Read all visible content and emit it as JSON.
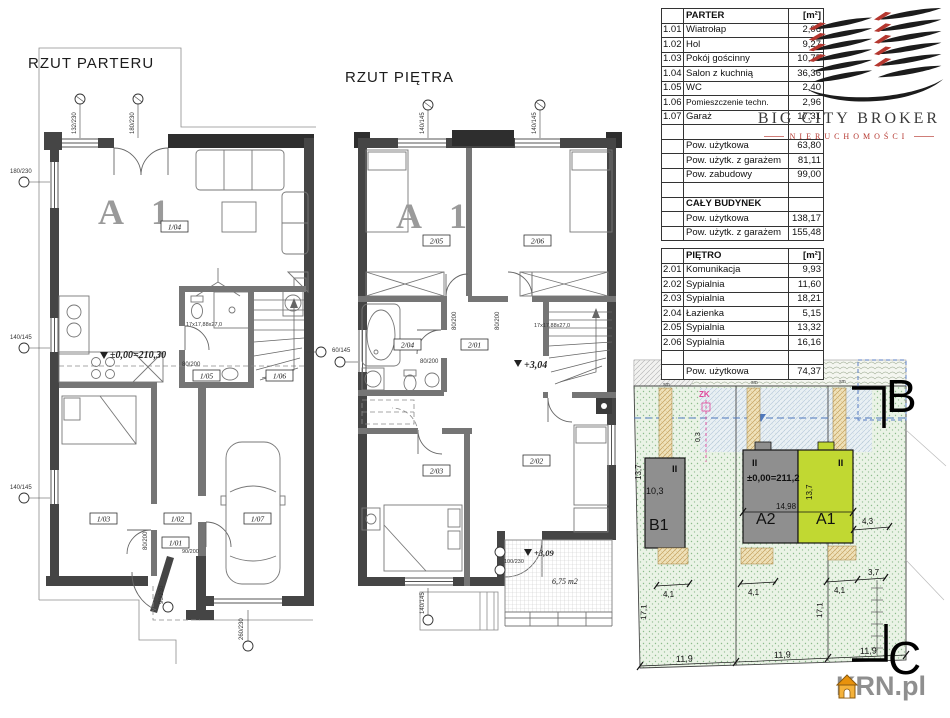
{
  "parter_plan": {
    "title": "RZUT PARTERU",
    "unit_label": "A 1",
    "level_mark": "±0,00=210,30",
    "stair_note": "17x17,88x27,0",
    "rooms": {
      "r101": "1/01",
      "r102": "1/02",
      "r103": "1/03",
      "r104": "1/04",
      "r105": "1/05",
      "r106": "1/06",
      "r107": "1/07"
    },
    "dims": {
      "win_top1": "132/230",
      "door_top": "180/230",
      "win_left1": "180/230",
      "win_left2": "140/145",
      "win_left3": "140/145",
      "door_a": "80/200",
      "door_b": "80/200",
      "door_entry": "90/200",
      "door_side": "90/230",
      "garage_door": "260/230"
    }
  },
  "pietro_plan": {
    "title": "RZUT PIĘTRA",
    "unit_label": "A 1",
    "level_mark": "+3,04",
    "balcony_level": "+3,09",
    "balcony_area": "6,75 m2",
    "stair_note": "17x17,88x27,0",
    "rooms": {
      "r201": "2/01",
      "r202": "2/02",
      "r203": "2/03",
      "r204": "2/04",
      "r205": "2/05",
      "r206": "2/06"
    },
    "dims": {
      "win_top1": "140/145",
      "win_top2": "140/145",
      "win_left": "60/145",
      "win_bottom": "140/145",
      "door_a": "80/200",
      "door_b": "80/200",
      "door_c": "80/200",
      "balcony_door": "100/230"
    }
  },
  "tables": {
    "parter": {
      "title": "PARTER",
      "unit": "[m²]",
      "rows": [
        {
          "no": "1.01",
          "name": "Wiatrołap",
          "area": "2,06"
        },
        {
          "no": "1.02",
          "name": "Hol",
          "area": "9,27"
        },
        {
          "no": "1.03",
          "name": "Pokój gościnny",
          "area": "10,75"
        },
        {
          "no": "1.04",
          "name": "Salon z kuchnią",
          "area": "36,36"
        },
        {
          "no": "1.05",
          "name": "WC",
          "area": "2,40"
        },
        {
          "no": "1.06",
          "name": "Pomieszczenie techn.",
          "area": "2,96"
        },
        {
          "no": "1.07",
          "name": "Garaż",
          "area": "17,31"
        }
      ],
      "summary": [
        {
          "name": "Pow. użytkowa",
          "area": "63,80"
        },
        {
          "name": "Pow. użytk. z garażem",
          "area": "81,11"
        },
        {
          "name": "Pow. zabudowy",
          "area": "99,00"
        }
      ],
      "building_title": "CAŁY BUDYNEK",
      "building": [
        {
          "name": "Pow. użytkowa",
          "area": "138,17"
        },
        {
          "name": "Pow. użytk. z garażem",
          "area": "155,48"
        }
      ]
    },
    "pietro": {
      "title": "PIĘTRO",
      "unit": "[m²]",
      "rows": [
        {
          "no": "2.01",
          "name": "Komunikacja",
          "area": "9,93"
        },
        {
          "no": "2.02",
          "name": "Sypialnia",
          "area": "11,60"
        },
        {
          "no": "2.03",
          "name": "Sypialnia",
          "area": "18,21"
        },
        {
          "no": "2.04",
          "name": "Łazienka",
          "area": "5,15"
        },
        {
          "no": "2.05",
          "name": "Sypialnia",
          "area": "13,32"
        },
        {
          "no": "2.06",
          "name": "Sypialnia",
          "area": "16,16"
        }
      ],
      "summary": [
        {
          "name": "Pow. użytkowa",
          "area": "74,37"
        }
      ]
    }
  },
  "logo": {
    "name": "BIG CITY BROKER",
    "tagline": "NIERUCHOMOŚCI"
  },
  "site_plan": {
    "section_top": "B",
    "section_bottom": "C",
    "buildings": {
      "b1": "B1",
      "a2": "A2",
      "a1": "A1"
    },
    "storeys": {
      "b1": "II",
      "a2": "II",
      "a1": "II"
    },
    "level_mark": "±0,00=211,2",
    "marker_zk": "ZK",
    "dims": {
      "plot1": "11,9",
      "plot2": "11,9",
      "plot3": "11,9",
      "terrace1": "4,1",
      "terrace2": "4,1",
      "terrace3": "4,1",
      "right_offset": "3,7",
      "side1": "17,1",
      "side2": "17,1",
      "depth1": "13,7",
      "depth2": "13,7",
      "b1_length": "10,3",
      "a1_offset": "4,3",
      "front_offset": "0,3",
      "total_width": "14,98",
      "sm1": "sm",
      "sm2": "sm",
      "sm3": "sm"
    }
  },
  "watermark": {
    "text": "KRN.pl"
  }
}
